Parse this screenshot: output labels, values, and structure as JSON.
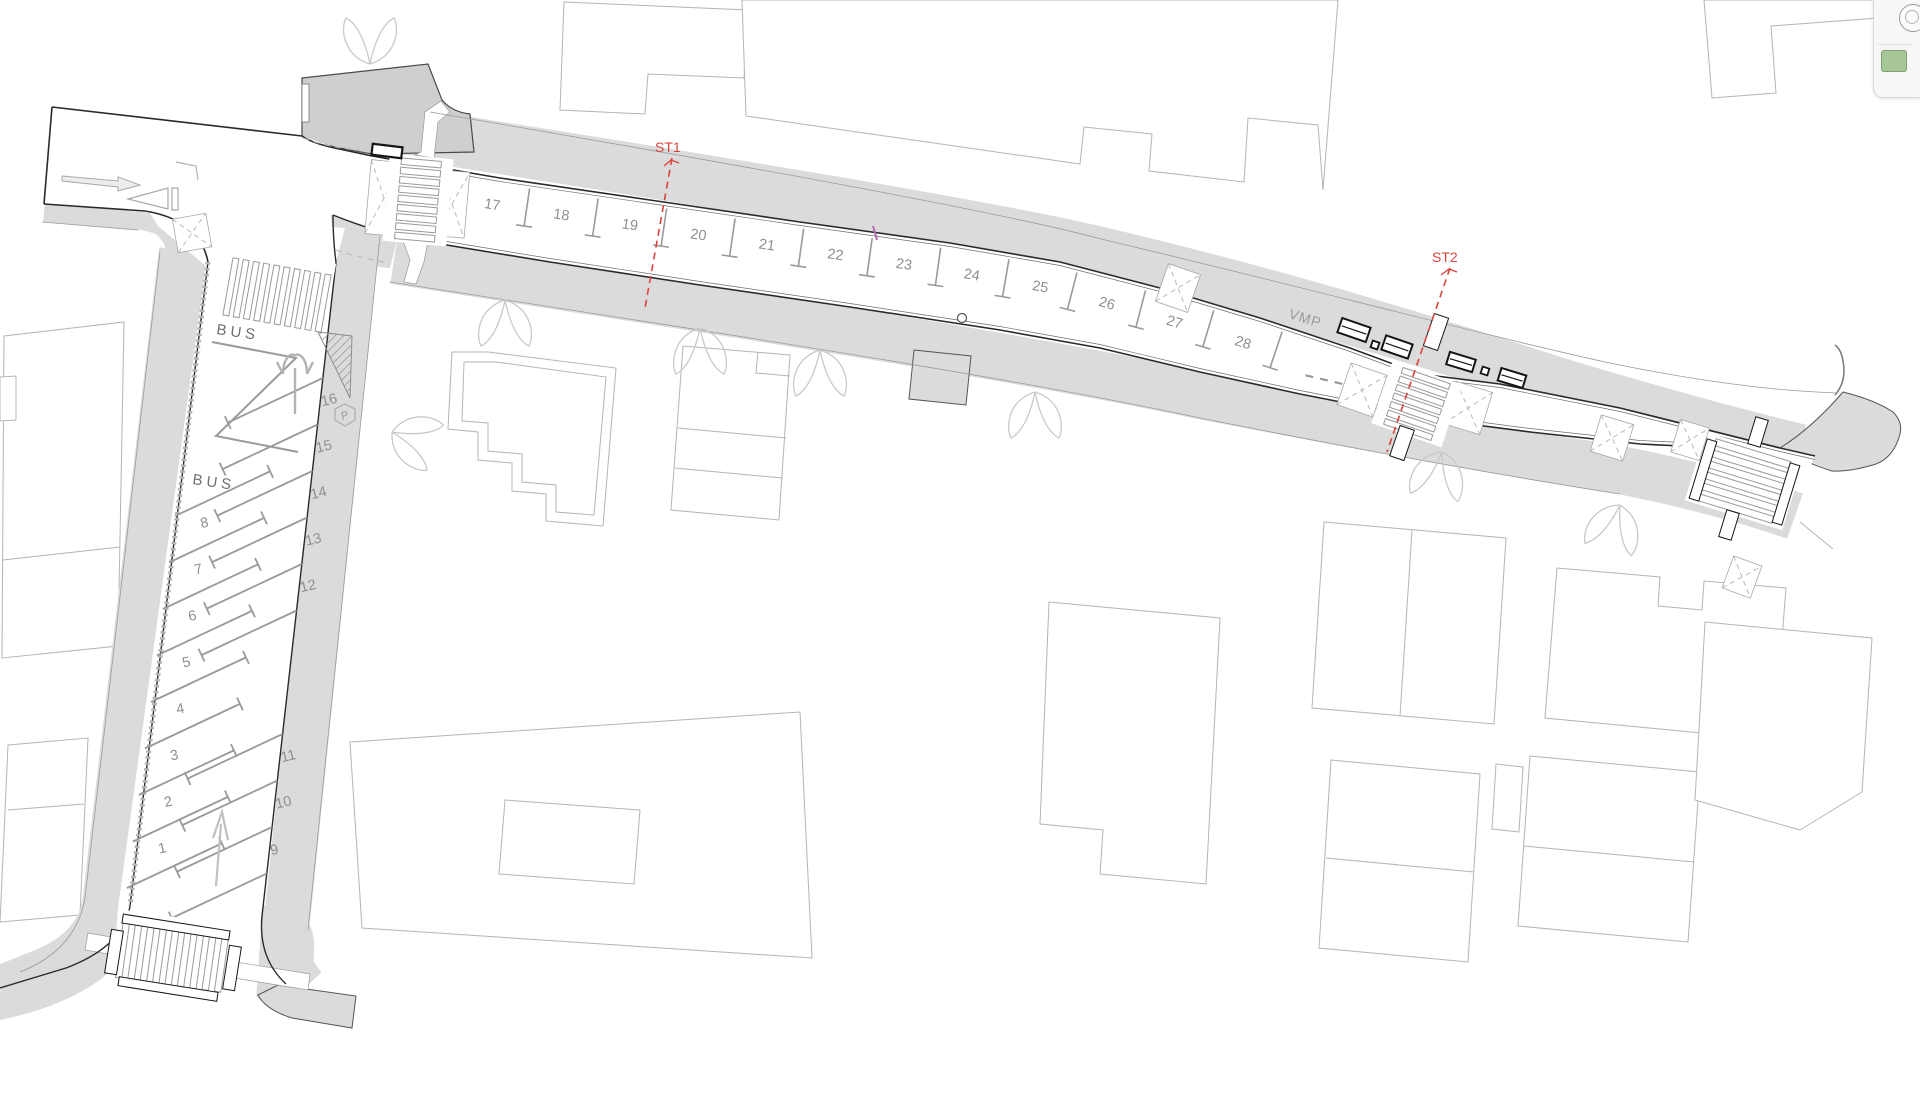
{
  "plan": {
    "section_markers": {
      "st1": "ST1",
      "st2": "ST2"
    },
    "vmp_label": "VMP",
    "bus_labels": [
      "BUS",
      "BUS"
    ],
    "parking_symbol": "P",
    "parking": {
      "main_street_spaces": [
        "17",
        "18",
        "19",
        "20",
        "21",
        "22",
        "23",
        "24",
        "25",
        "26",
        "27",
        "28"
      ],
      "lot_left_spaces": [
        "1",
        "2",
        "3",
        "4",
        "5",
        "6",
        "7",
        "8"
      ],
      "lot_right_upper_spaces": [
        "12",
        "13",
        "14",
        "15",
        "16"
      ],
      "lot_right_lower_spaces": [
        "9",
        "10",
        "11"
      ]
    },
    "colors": {
      "section_line": "#d9453c",
      "sidewalk": "#dbdbdb",
      "plaza": "#cfcfcf",
      "curb": "#2a2a2a",
      "marking": "#9a9a9a",
      "building_outline": "#b5b5b5"
    }
  },
  "side_panel": {
    "icons": [
      {
        "name": "circle-icon"
      },
      {
        "name": "green-file-icon"
      }
    ]
  }
}
